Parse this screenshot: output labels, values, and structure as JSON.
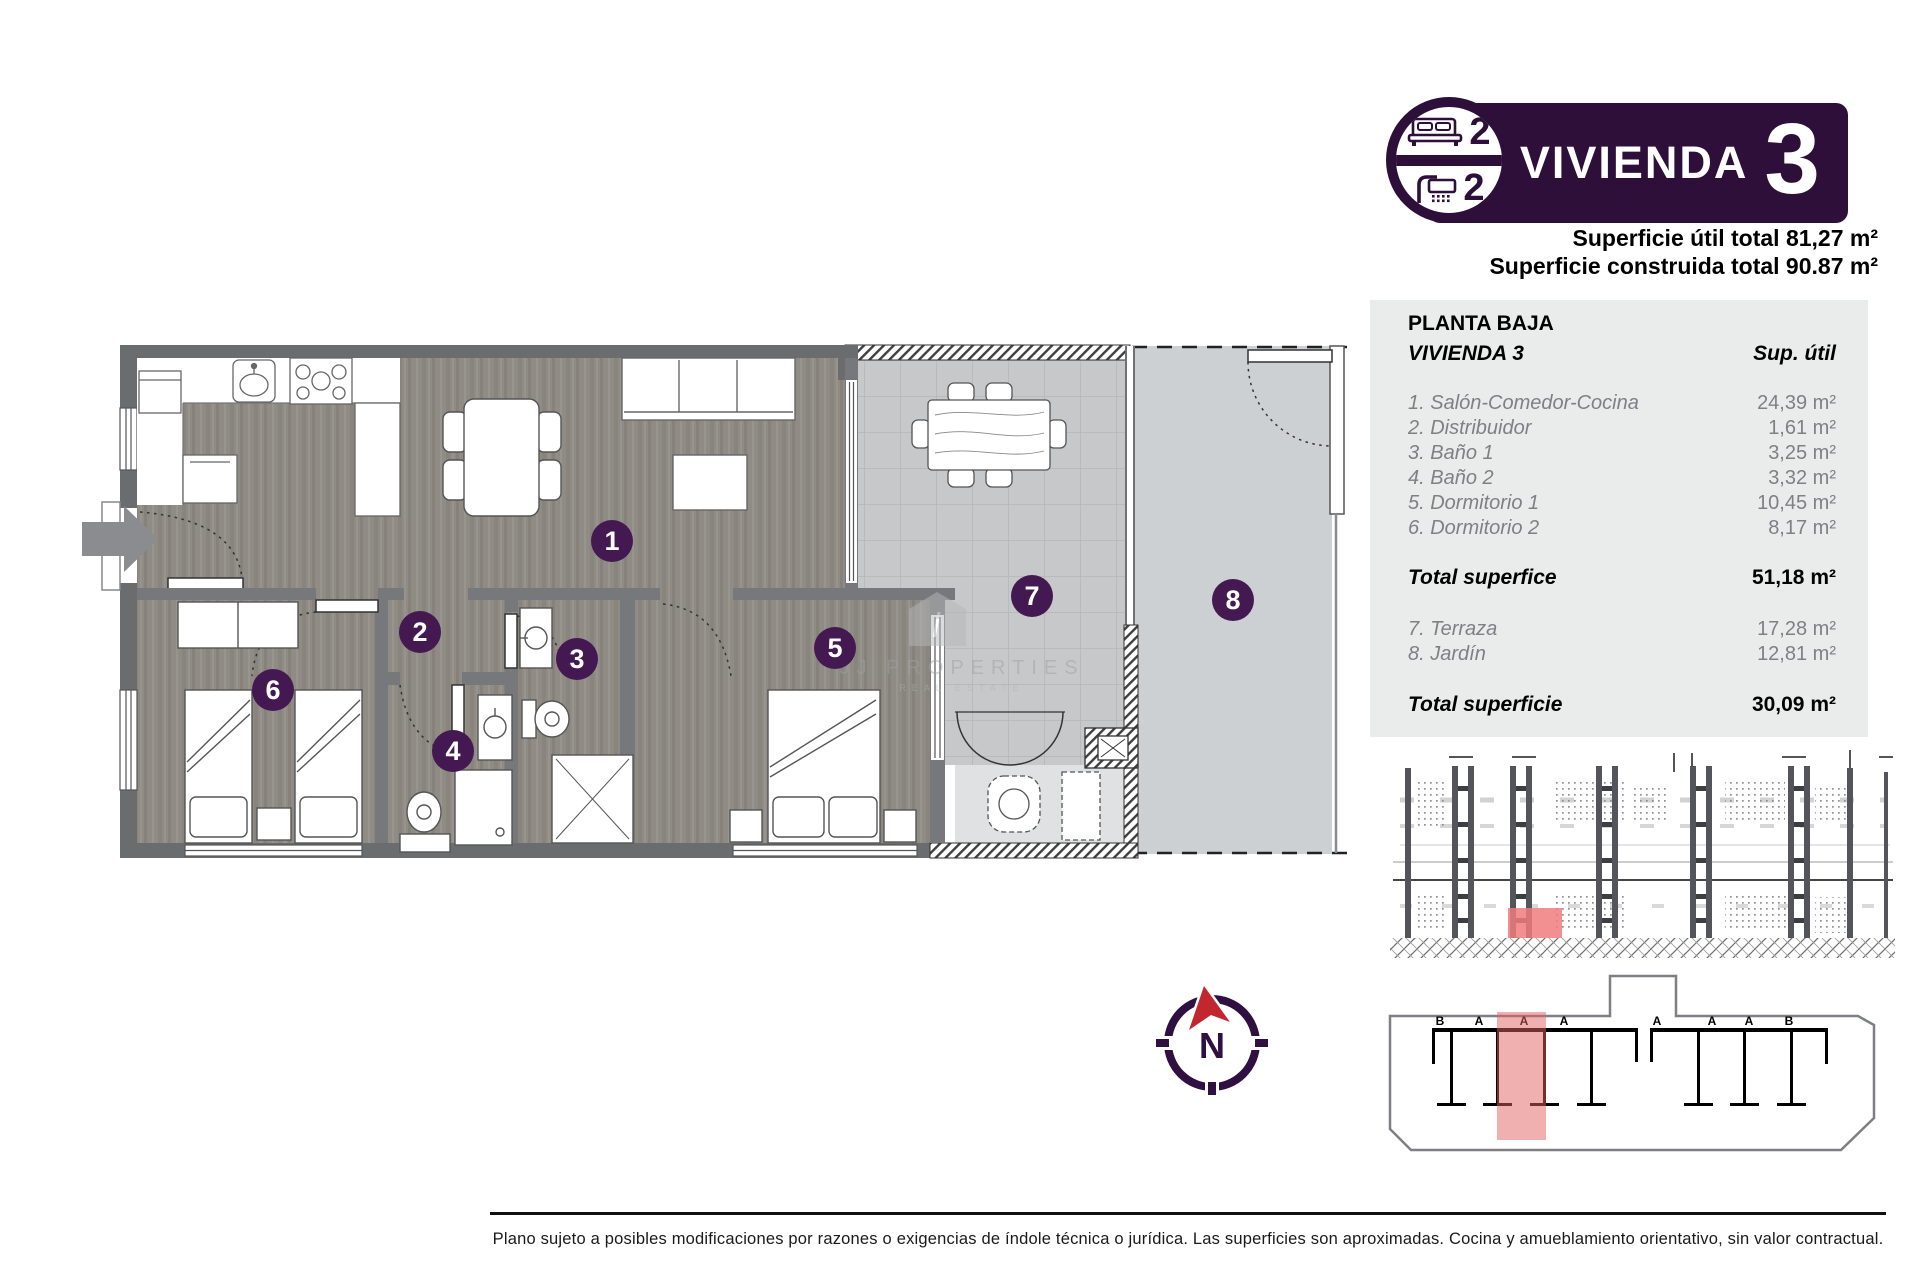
{
  "header": {
    "bedrooms": "2",
    "bathrooms": "2",
    "title": "VIVIENDA",
    "unit_number": "3",
    "area_line1": "Superficie útil total 81,27 m²",
    "area_line2": "Superficie construida total 90.87 m²"
  },
  "table": {
    "floor": "PLANTA BAJA",
    "unit": "VIVIENDA 3",
    "col_header": "Sup. útil",
    "rows": [
      {
        "label": "1. Salón-Comedor-Cocina",
        "value": "24,39 m²"
      },
      {
        "label": "2. Distribuidor",
        "value": "1,61 m²"
      },
      {
        "label": "3. Baño 1",
        "value": "3,25 m²"
      },
      {
        "label": "4. Baño 2",
        "value": "3,32 m²"
      },
      {
        "label": "5. Dormitorio 1",
        "value": "10,45 m²"
      },
      {
        "label": "6. Dormitorio 2",
        "value": "8,17 m²"
      }
    ],
    "total_interior": {
      "label": "Total superfice",
      "value": "51,18 m²"
    },
    "outdoor_rows": [
      {
        "label": "7. Terraza",
        "value": "17,28 m²"
      },
      {
        "label": "8. Jardín",
        "value": "12,81 m²"
      }
    ],
    "total_outdoor": {
      "label": "Total superficie",
      "value": "30,09 m²"
    }
  },
  "plan": {
    "badges": [
      "1",
      "2",
      "3",
      "4",
      "5",
      "6",
      "7",
      "8"
    ]
  },
  "watermark": {
    "logo_letter": "i",
    "line1": "JJ PROPERTIES",
    "line2": "REAL ESTATE"
  },
  "compass": {
    "north": "N"
  },
  "site_plan": {
    "labels": [
      "B",
      "A",
      "A",
      "A",
      "A",
      "A",
      "A",
      "B"
    ]
  },
  "footer": {
    "disclaimer": "Plano sujeto a posibles modificaciones por razones o exigencias de índole técnica o jurídica. Las superficies son aproximadas. Cocina y amueblamiento orientativo, sin valor contractual."
  },
  "colors": {
    "brand_purple": "#2e0f3a",
    "badge_purple": "#441952",
    "highlight_red": "#ef7b7e",
    "site_highlight": "#e26262",
    "compass_red": "#c22730"
  }
}
